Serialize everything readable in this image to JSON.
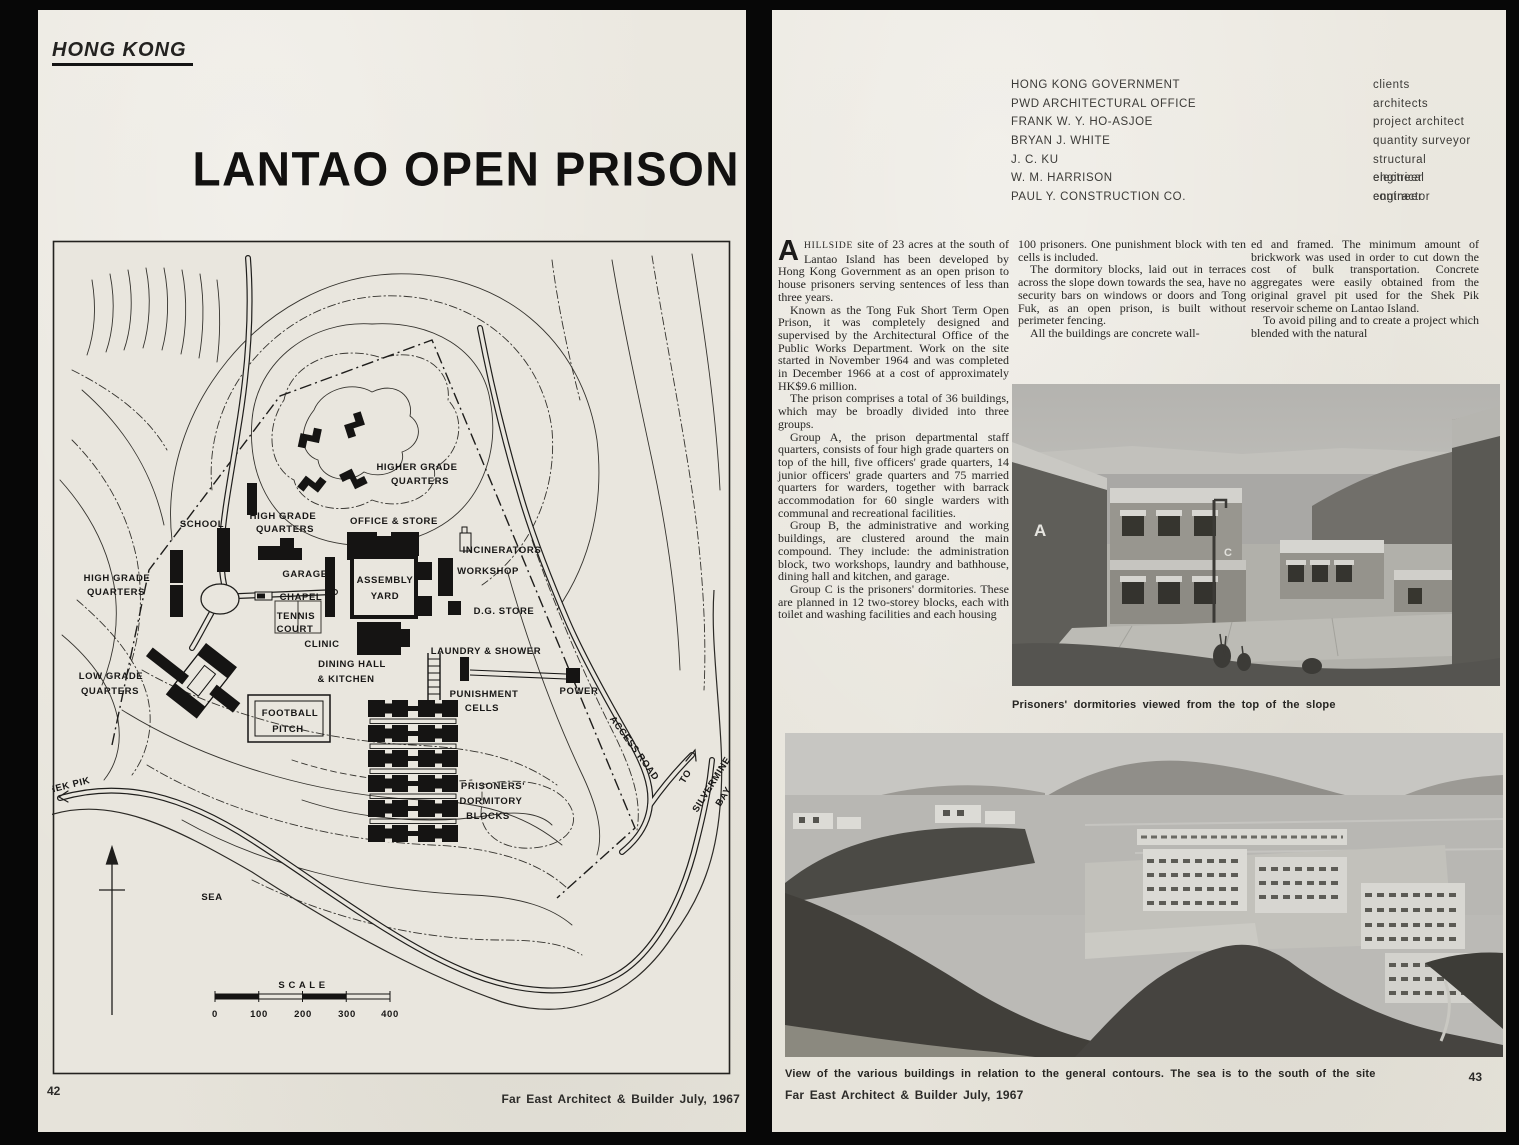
{
  "left_page": {
    "kicker": "HONG KONG",
    "title": "LANTAO OPEN PRISON",
    "page_number": "42",
    "footer": "Far East Architect & Builder July, 1967",
    "map": {
      "labels": [
        {
          "t": "HIGHER GRADE",
          "x": 365,
          "y": 230
        },
        {
          "t": "QUARTERS",
          "x": 368,
          "y": 244
        },
        {
          "t": "SCHOOL",
          "x": 150,
          "y": 287
        },
        {
          "t": "HIGH GRADE",
          "x": 231,
          "y": 279
        },
        {
          "t": "QUARTERS",
          "x": 233,
          "y": 292
        },
        {
          "t": "OFFICE & STORE",
          "x": 342,
          "y": 284
        },
        {
          "t": "INCINERATORS",
          "x": 450,
          "y": 313
        },
        {
          "t": "WORKSHOP",
          "x": 436,
          "y": 334
        },
        {
          "t": "HIGH GRADE",
          "x": 65,
          "y": 341
        },
        {
          "t": "QUARTERS",
          "x": 64,
          "y": 355
        },
        {
          "t": "GARAGE",
          "x": 253,
          "y": 337
        },
        {
          "t": "ASSEMBLY",
          "x": 333,
          "y": 343
        },
        {
          "t": "YARD",
          "x": 333,
          "y": 359
        },
        {
          "t": "CHAPEL",
          "x": 249,
          "y": 360
        },
        {
          "t": "TENNIS",
          "x": 244,
          "y": 379
        },
        {
          "t": "COURT",
          "x": 243,
          "y": 392
        },
        {
          "t": "D.G. STORE",
          "x": 452,
          "y": 374
        },
        {
          "t": "CLINIC",
          "x": 270,
          "y": 407
        },
        {
          "t": "LAUNDRY & SHOWER",
          "x": 434,
          "y": 414
        },
        {
          "t": "DINING HALL",
          "x": 300,
          "y": 427
        },
        {
          "t": "& KITCHEN",
          "x": 294,
          "y": 442
        },
        {
          "t": "LOW GRADE",
          "x": 59,
          "y": 439
        },
        {
          "t": "QUARTERS",
          "x": 58,
          "y": 454
        },
        {
          "t": "PUNISHMENT",
          "x": 432,
          "y": 457
        },
        {
          "t": "CELLS",
          "x": 430,
          "y": 471
        },
        {
          "t": "POWER",
          "x": 527,
          "y": 454
        },
        {
          "t": "FOOTBALL",
          "x": 238,
          "y": 476
        },
        {
          "t": "PITCH",
          "x": 236,
          "y": 492
        },
        {
          "t": "PRISONERS'",
          "x": 441,
          "y": 549
        },
        {
          "t": "DORMITORY",
          "x": 439,
          "y": 564
        },
        {
          "t": "BLOCKS",
          "x": 436,
          "y": 579
        },
        {
          "t": "ACCESS ROAD",
          "x": 580,
          "y": 510,
          "r": 54,
          "ls": 3
        },
        {
          "t": "TO",
          "x": 636,
          "y": 538,
          "r": -58
        },
        {
          "t": "SILVERMINE",
          "x": 662,
          "y": 546,
          "r": -58
        },
        {
          "t": "BAY",
          "x": 674,
          "y": 558,
          "r": -58
        },
        {
          "t": "TO SHEK PIK",
          "x": 6,
          "y": 551,
          "r": -14,
          "a": "start"
        },
        {
          "t": "SEA",
          "x": 160,
          "y": 660,
          "ls": 7
        },
        {
          "t": "S C A L E",
          "x": 250,
          "y": 748,
          "ls": 2
        }
      ],
      "scale_ticks": [
        "0",
        "100",
        "200",
        "300",
        "400"
      ]
    }
  },
  "right_page": {
    "credits": [
      {
        "name": "HONG KONG GOVERNMENT",
        "role": "clients"
      },
      {
        "name": "PWD ARCHITECTURAL OFFICE",
        "role": "architects"
      },
      {
        "name": "FRANK W. Y. HO-ASJOE",
        "role": "project architect"
      },
      {
        "name": "BRYAN J. WHITE",
        "role": "quantity surveyor"
      },
      {
        "name": "J. C. KU",
        "role": "structural engineer"
      },
      {
        "name": "W. M. HARRISON",
        "role": "electrical engineer"
      },
      {
        "name": "PAUL Y. CONSTRUCTION CO.",
        "role": "contractor"
      }
    ],
    "article": {
      "dropcap": "A",
      "lead_word": "HILLSIDE",
      "lead_rest": " site of 23 acres at the south of Lantao Island has been developed by Hong Kong Government as an open prison to house prisoners serving sentences of less than three years.",
      "col1": [
        "Known as the Tong Fuk Short Term Open Prison, it was completely designed and supervised by the Architectural Office of the Public Works Department. Work on the site started in November 1964 and was completed in December 1966 at a cost of approximately HK$9.6 million.",
        "The prison comprises a total of 36 buildings, which may be broadly divided into three groups.",
        "Group A, the prison departmental staff quarters, consists of four high grade quarters on top of the hill, five officers' grade quarters, 14 junior officers' grade quarters and 75 married quarters for warders, together with barrack accommodation for 60 single warders with communal and recreational facilities.",
        "Group B, the administrative and working buildings, are clustered around the main compound. They include: the administration block, two workshops, laundry and bathhouse, dining hall and kitchen, and garage.",
        "Group C is the prisoners' dormitories. These are planned in 12 two-storey blocks, each with toilet and washing facilities and each housing"
      ],
      "col2": [
        "100 prisoners. One punishment block with ten cells is included.",
        "The dormitory blocks, laid out in terraces across the slope down towards the sea, have no security bars on windows or doors and Tong Fuk, as an open prison, is built without perimeter fencing.",
        "All the buildings are concrete wall-"
      ],
      "col3": [
        "ed and framed. The minimum amount of brickwork was used in order to cut down the cost of bulk transportation. Concrete aggregates were easily obtained from the original gravel pit used for the Shek Pik reservoir scheme on Lantao Island.",
        "To avoid piling and to create a project which blended with the natural"
      ]
    },
    "photo1_caption": "Prisoners' dormitories viewed from the top of the slope",
    "photo2_caption": "View of the various buildings in relation to the general contours. The sea is to the south of the site",
    "page_number": "43",
    "footer": "Far East Architect & Builder July, 1967"
  }
}
